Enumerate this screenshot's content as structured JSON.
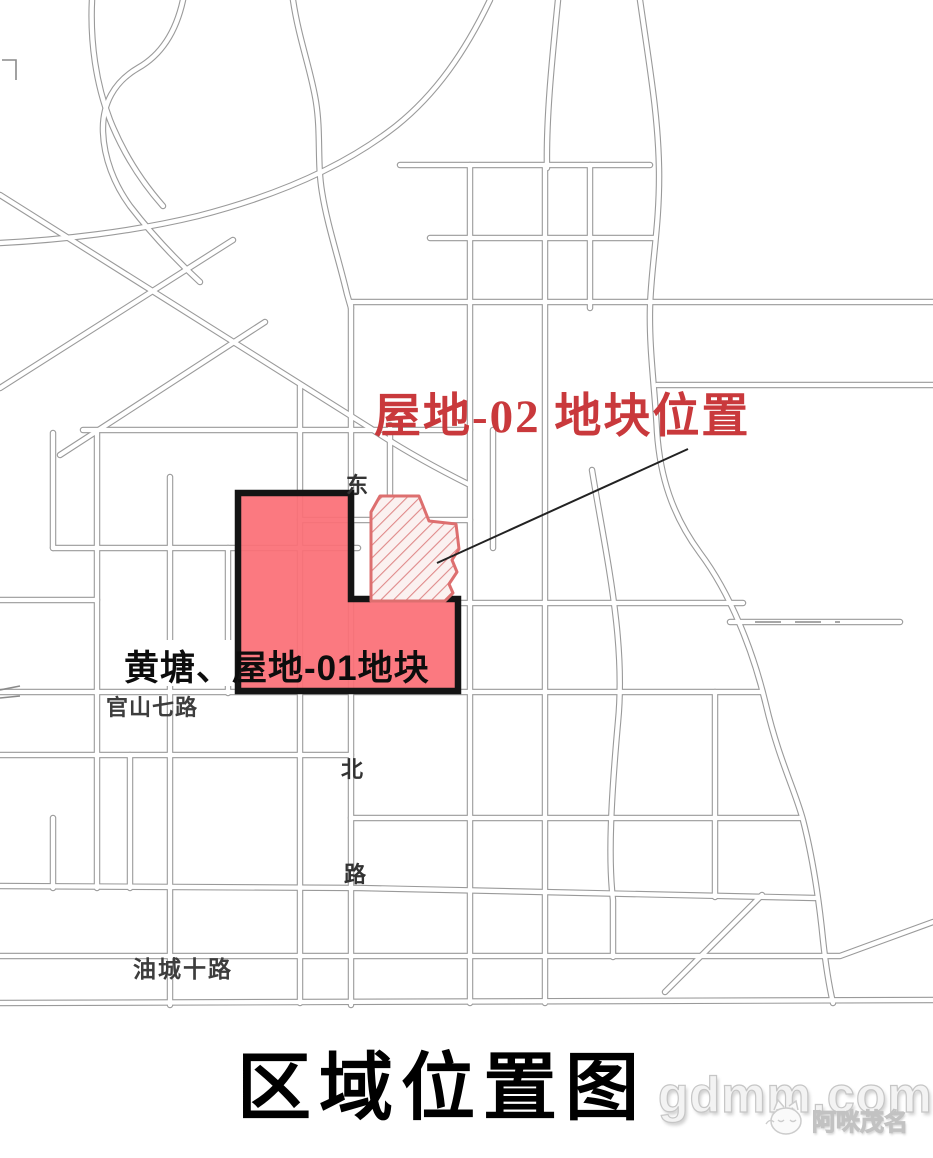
{
  "map": {
    "callout": {
      "text": "屋地-02 地块位置",
      "color": "#c9393c"
    },
    "parcel_label": {
      "text": "黄塘、屋地-01地块",
      "color": "#0d0d0d"
    },
    "parcels": {
      "parcel01_fill": "#fb6f76",
      "parcel01_border": "#141414",
      "parcel02_outline": "#dd6f6f",
      "parc02_hatch_background": "#fbf1f0"
    },
    "road_labels": {
      "guanshan7": "官山七路",
      "youcheng10": "油城十路",
      "vertical_chars": [
        "东",
        "北",
        "路"
      ]
    },
    "title": "区域位置图",
    "road_casing_color": "#9a9a9a"
  },
  "watermark": {
    "site": "gdmm.com",
    "brand": "阿咪茂名"
  }
}
